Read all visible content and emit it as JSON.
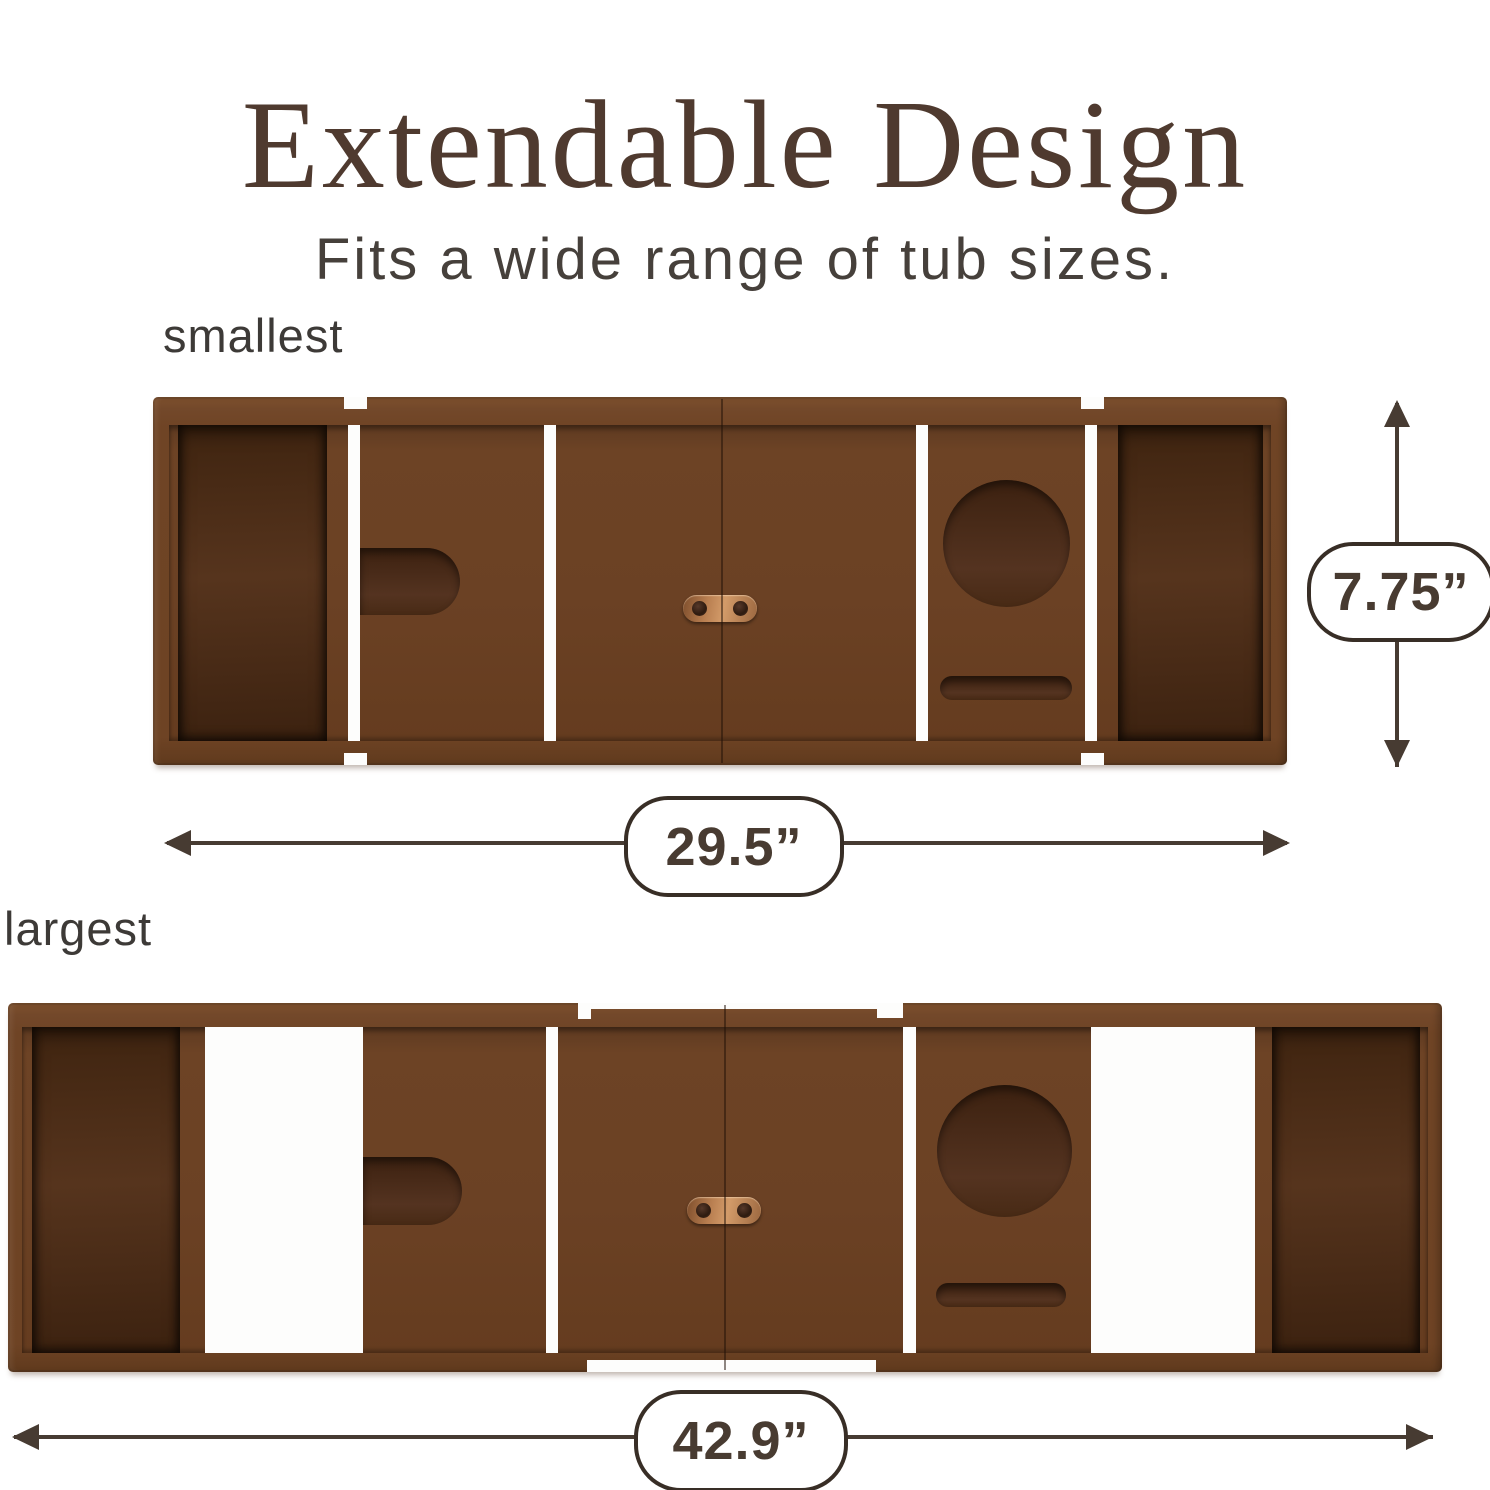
{
  "header": {
    "title": "Extendable Design",
    "subtitle": "Fits a wide range of tub sizes."
  },
  "trays": {
    "small": {
      "label": "smallest",
      "width_label": "29.5”",
      "height_label": "7.75”"
    },
    "large": {
      "label": "largest",
      "width_label": "42.9”"
    }
  },
  "colors": {
    "background": "#ffffff",
    "title_text": "#4f3a2f",
    "label_text": "#3d3a37",
    "wood_frame": "#6f4425",
    "wood_panel": "#6b4124",
    "wood_dark_recess": "#46290f",
    "copper_hinge": "#c08355",
    "dimension_outline": "#473b32"
  }
}
